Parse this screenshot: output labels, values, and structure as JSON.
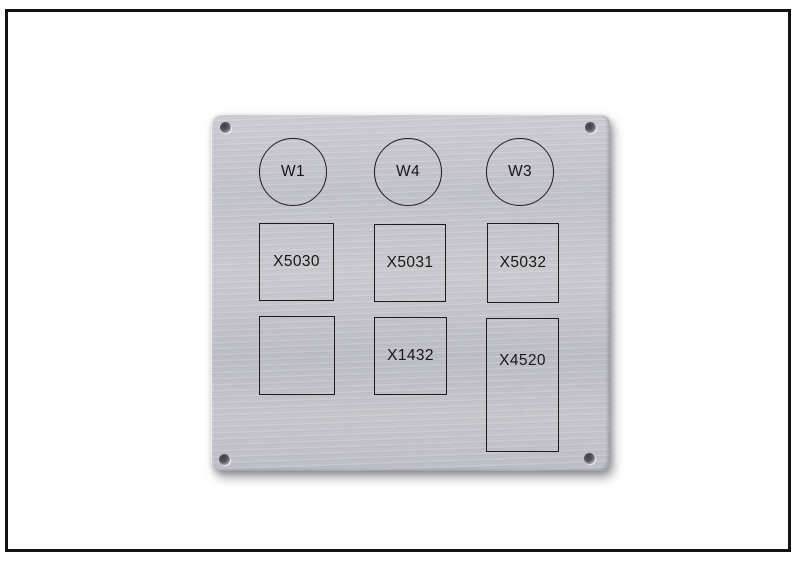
{
  "scene": {
    "background_color": "#ffffff",
    "frame_color": "#141414",
    "description": "Brushed aluminium front panel with engraved connector outlines"
  },
  "panel": {
    "base_color": "#c4c4ca",
    "engraving_color": "#1c1c1f",
    "screw_holes": [
      {
        "position": "top-left"
      },
      {
        "position": "top-right"
      },
      {
        "position": "bottom-left"
      },
      {
        "position": "bottom-right"
      }
    ],
    "circles": [
      {
        "label": "W1"
      },
      {
        "label": "W4"
      },
      {
        "label": "W3"
      }
    ],
    "squares_row1": [
      {
        "label": "X5030"
      },
      {
        "label": "X5031"
      },
      {
        "label": "X5032"
      }
    ],
    "squares_row2": [
      {
        "label": ""
      },
      {
        "label": "X1432"
      },
      {
        "label": "X4520"
      }
    ]
  }
}
